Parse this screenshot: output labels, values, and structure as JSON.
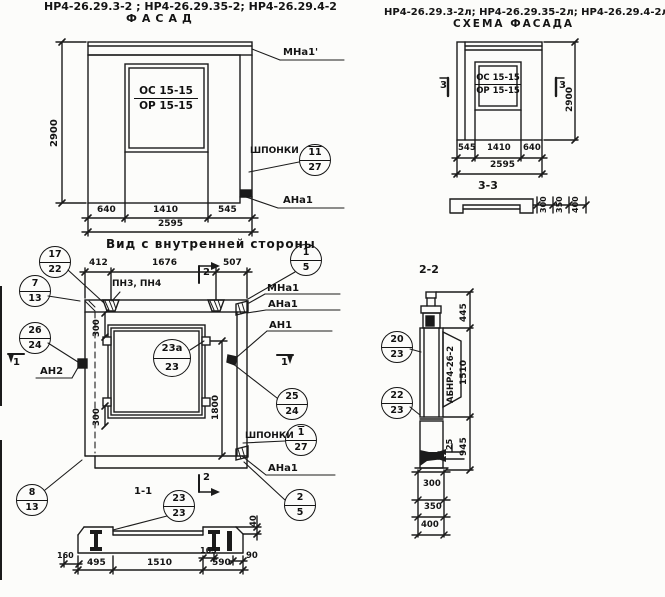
{
  "header": {
    "left_marks": "НР4-26.29.3-2 ; НР4-26.29.35-2; НР4-26.29.4-2",
    "left_subtitle": "ФАСАД",
    "right_marks": "НР4-26.29.3-2л; НР4-26.29.35-2л; НР4-26.29.4-2л",
    "right_subtitle": "СХЕМА ФАСАДА"
  },
  "facade": {
    "window_line1": "ОС 15-15",
    "window_line2": "ОР 15-15",
    "dim_height": "2900",
    "dim_left": "640",
    "dim_mid": "1410",
    "dim_right": "545",
    "dim_total": "2595",
    "label_mna1": "МНа1'",
    "label_shponki": "ШПОНКИ",
    "label_ana1": "АНа1"
  },
  "scheme": {
    "window_line1": "ОС 15-15",
    "window_line2": "ОР 15-15",
    "dim_height": "2900",
    "dim_left": "545",
    "dim_mid": "1410",
    "dim_right": "640",
    "dim_total": "2595",
    "marker_left": "3",
    "marker_right": "3"
  },
  "section33": {
    "title": "3-3",
    "dims": [
      "300",
      "350",
      "400"
    ]
  },
  "inner": {
    "title": "Вид с внутренней стороны",
    "dim_412": "412",
    "dim_1676": "1676",
    "dim_507": "507",
    "label_pn": "ПН3, ПН4",
    "marker_sec2": "2",
    "marker_sec1": "1",
    "dim_300_top": "300",
    "dim_300_bottom": "300",
    "dim_1800": "1800",
    "label_an2": "АН2",
    "label_mna1": "МНа1",
    "label_ana1_top": "АНа1",
    "label_an1": "АН1",
    "label_shponki": "ШПОНКИ",
    "label_ana1_bottom": "АНа1"
  },
  "section11": {
    "title": "1-1",
    "dim_160": "160",
    "dim_495": "495",
    "dim_1510": "1510",
    "dim_590": "590",
    "dim_165": "165",
    "dim_90": "90",
    "dim_40": "40"
  },
  "section22": {
    "title": "2-2",
    "label_rot": "АБНР4-26-2",
    "dim_445": "445",
    "dim_1510": "1510",
    "dim_945": "945",
    "dim_25": "25",
    "dims_stack": [
      "300",
      "350",
      "400"
    ]
  },
  "markers": [
    {
      "id": "shponki-facade",
      "top": "11",
      "bottom": "27"
    },
    {
      "id": "pos-17-22",
      "top": "17",
      "bottom": "22"
    },
    {
      "id": "pos-7-13",
      "top": "7",
      "bottom": "13"
    },
    {
      "id": "pos-26-24",
      "top": "26",
      "bottom": "24"
    },
    {
      "id": "pos-23a-23",
      "top": "23а",
      "bottom": "23"
    },
    {
      "id": "pos-1-5",
      "top": "1",
      "bottom": "5"
    },
    {
      "id": "pos-25-24",
      "top": "25",
      "bottom": "24"
    },
    {
      "id": "shponki-inner",
      "top": "1",
      "bottom": "27"
    },
    {
      "id": "pos-2-5",
      "top": "2",
      "bottom": "5"
    },
    {
      "id": "pos-8-13",
      "top": "8",
      "bottom": "13"
    },
    {
      "id": "pos-23-23",
      "top": "23",
      "bottom": "23"
    },
    {
      "id": "pos-20-23",
      "top": "20",
      "bottom": "23"
    },
    {
      "id": "pos-22-23",
      "top": "22",
      "bottom": "23"
    }
  ]
}
